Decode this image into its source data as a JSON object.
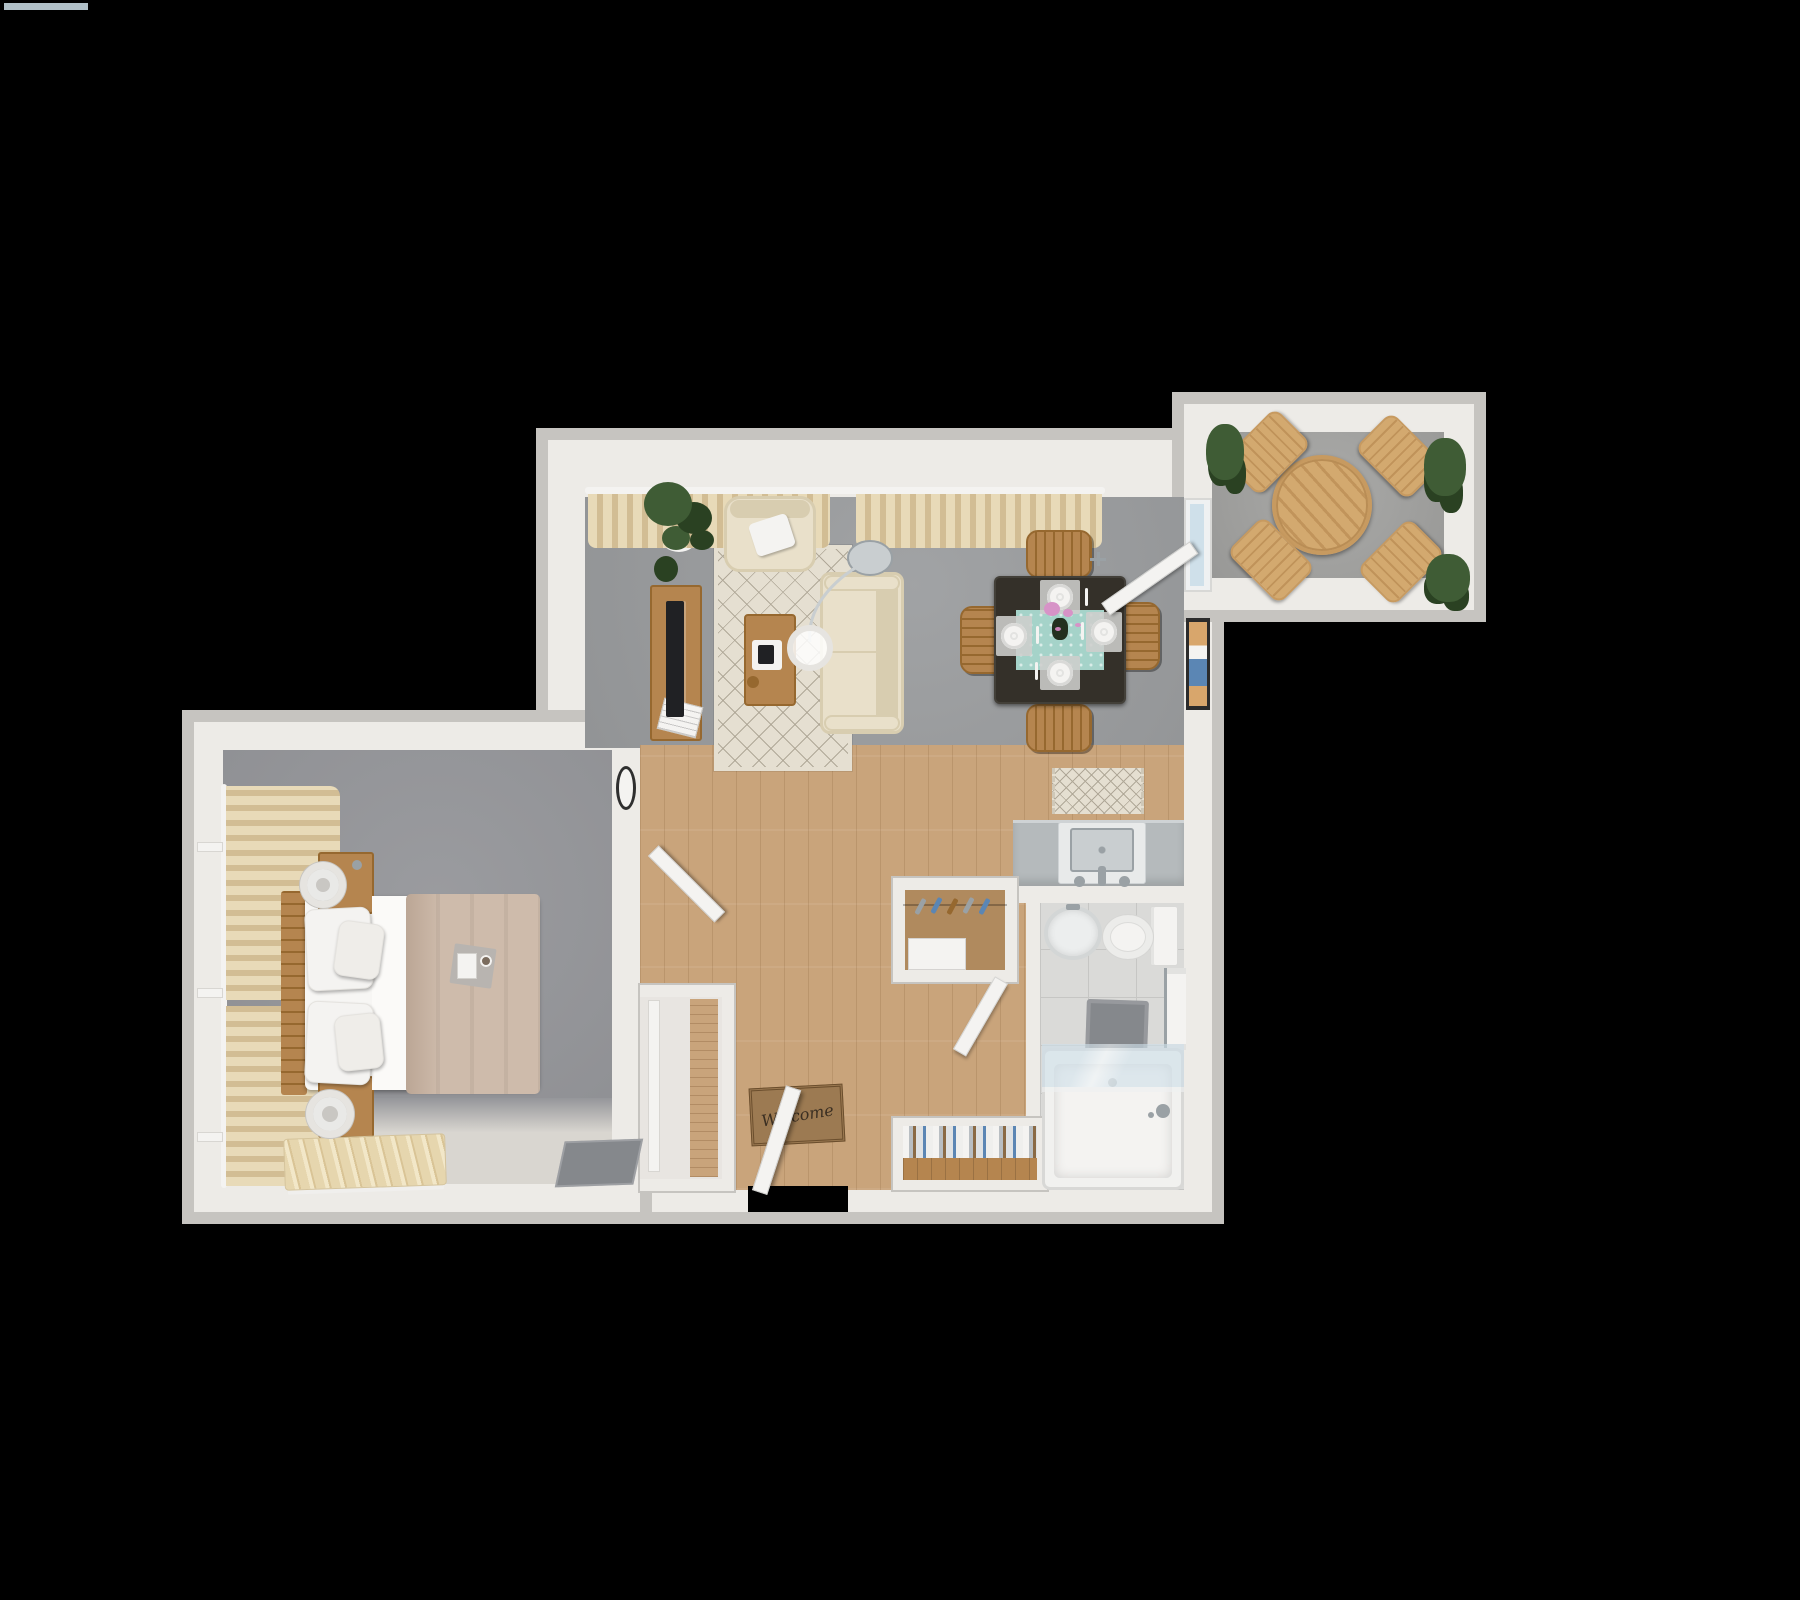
{
  "scene": {
    "description": "Top-down 3D rendered one-bedroom apartment floor plan on a black background",
    "background": "#000000",
    "canvas": {
      "width": 1800,
      "height": 1600
    }
  },
  "text": {
    "welcome_mat": "Welcome"
  },
  "palette": {
    "black": "#000000",
    "wall": "#edebe7",
    "wall_edge": "#c6c4c0",
    "carpet": "#9b9d9f",
    "carpet_bed": "#95969a",
    "carpet_light": "#d9d6d0",
    "wood": "#c9a47b",
    "wood_line": "#b08a5e",
    "tile": "#dadad8",
    "tile_line": "#c6c6c4",
    "balcony_floor": "#a5a5a3",
    "cream": "#e9e0ca",
    "cream_dark": "#d8cdb0",
    "rug": "#e5dfd1",
    "rug_line": "#b0a898",
    "wood_furn": "#b5854f",
    "wood_furn_dark": "#96682f",
    "wood_light": "#d3a96f",
    "table_dark": "#343029",
    "curtain": "#e8dab8",
    "curtain_dark": "#d2bd94",
    "duvet": "#cebbab",
    "duvet_dark": "#bba695",
    "sheet": "#f7f6f4",
    "white": "#f4f3f1",
    "plant": "#3f5c35",
    "plant_dark": "#2a4122",
    "counter": "#b5babc",
    "counter_edge": "#cfd3d5",
    "steel": "#c9ced0",
    "steel_dark": "#9aa1a5",
    "teal": "#a5d3c9",
    "mat_brown": "#9c7a52",
    "mat_border": "#6b4e2d",
    "mat_text": "#3b2f22",
    "glass": "#cfe0ea",
    "glass_frame": "#eff1f2",
    "gray_mat": "#85888c",
    "tv": "#202124",
    "art_frame": "#2b2b2b",
    "art_blue": "#5b86b4",
    "art_tan": "#d8a66c",
    "pink": "#d793c7",
    "lamp_ring": "#e6e4e0",
    "lamp_inner": "#c9c7c3"
  },
  "rooms": {
    "living_room": {
      "floor": "gray carpet",
      "items": [
        "potted-plant",
        "tv-console",
        "tv",
        "magazine-stack",
        "armchair",
        "throw-pillow",
        "area-rug",
        "loveseat-sofa",
        "coffee-table",
        "decor-tray",
        "arc-floor-lamp",
        "window-curtains",
        "wall-panel"
      ]
    },
    "dining_area": {
      "floor": "gray carpet",
      "items": [
        "dining-table",
        "dining-chair-north",
        "dining-chair-south",
        "dining-chair-east",
        "dining-chair-west",
        "place-settings-x4",
        "table-runner",
        "flower-centerpiece",
        "framed-wall-art",
        "balcony-glass-door"
      ]
    },
    "kitchen": {
      "floor": "wood plank",
      "items": [
        "counter",
        "sink",
        "faucet",
        "runner-rug"
      ]
    },
    "hallway_entry": {
      "floor": "wood plank",
      "items": [
        "entry-door",
        "welcome-mat",
        "coat-closet",
        "clothes-hangers-x5",
        "closet-shelf",
        "linen-closet",
        "wall-oval-panel"
      ]
    },
    "bathroom": {
      "floor": "tile",
      "items": [
        "pedestal-sink",
        "toilet",
        "bath-mat",
        "towel-rack",
        "bathtub",
        "glass-shower-screen",
        "tub-faucet"
      ]
    },
    "bedroom": {
      "floor": "gray carpet",
      "items": [
        "double-bed",
        "headboard",
        "pillows-x4",
        "duvet",
        "breakfast-tray",
        "nightstand-x2",
        "table-lamp-x2",
        "window-curtains",
        "slatted-bench",
        "closet",
        "floor-mat",
        "door"
      ]
    },
    "balcony": {
      "floor": "concrete",
      "items": [
        "round-patio-table",
        "patio-chair-x4",
        "potted-plant-x3"
      ]
    }
  }
}
